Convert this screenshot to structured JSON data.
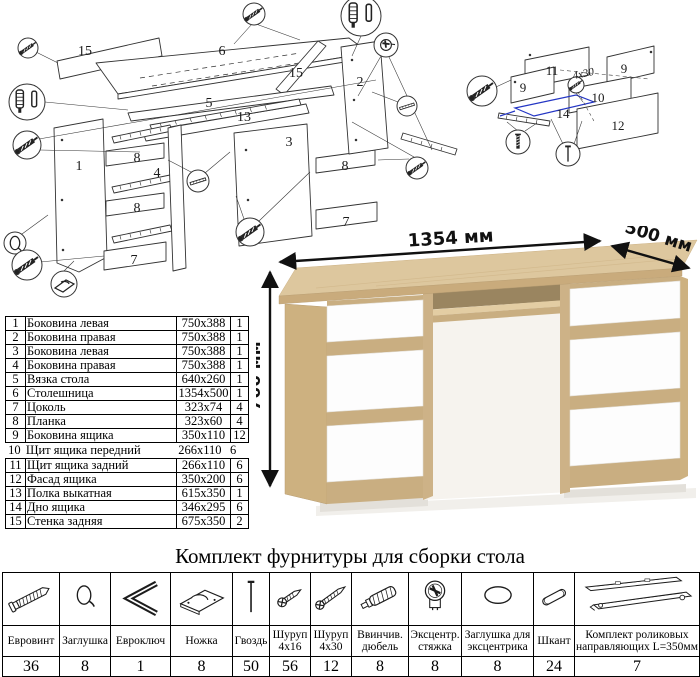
{
  "sheet": {
    "bg": "#ffffff"
  },
  "desk": {
    "dim_width": "1354 мм",
    "dim_depth": "500 мм",
    "dim_height": "766 мм",
    "colors": {
      "oak": "#ddc79e",
      "oak_mid": "#c9ae81",
      "oak_dark": "#9a8560",
      "drawer_white": "#fdfdfd"
    }
  },
  "exploded_main": {
    "labels": [
      "15",
      "6",
      "15",
      "5",
      "2",
      "13",
      "3",
      "8",
      "7",
      "1",
      "8",
      "4",
      "8",
      "7"
    ]
  },
  "exploded_drawer": {
    "labels": [
      "11",
      "9",
      "9",
      "10",
      "14",
      "12"
    ],
    "screw_note": "4x30",
    "accent": "#2436c4"
  },
  "parts_table": {
    "rows": [
      {
        "num": "1",
        "name": "Боковина левая",
        "size": "750x388",
        "qty": "1"
      },
      {
        "num": "2",
        "name": "Боковина правая",
        "size": "750x388",
        "qty": "1"
      },
      {
        "num": "3",
        "name": "Боковина левая",
        "size": "750x388",
        "qty": "1"
      },
      {
        "num": "4",
        "name": "Боковина правая",
        "size": "750x388",
        "qty": "1"
      },
      {
        "num": "5",
        "name": "Вязка стола",
        "size": "640x260",
        "qty": "1"
      },
      {
        "num": "6",
        "name": "Столешница",
        "size": "1354x500",
        "qty": "1"
      },
      {
        "num": "7",
        "name": "Цоколь",
        "size": "323x74",
        "qty": "4"
      },
      {
        "num": "8",
        "name": "Планка",
        "size": "323x60",
        "qty": "4"
      },
      {
        "num": "9",
        "name": "Боковина ящика",
        "size": "350x110",
        "qty": "12"
      },
      {
        "num": "10",
        "name": "Щит ящика передний",
        "size": "266x110",
        "qty": "6"
      },
      {
        "num": "11",
        "name": "Щит ящика задний",
        "size": "266x110",
        "qty": "6"
      },
      {
        "num": "12",
        "name": "Фасад ящика",
        "size": "350x200",
        "qty": "6"
      },
      {
        "num": "13",
        "name": "Полка выкатная",
        "size": "615x350",
        "qty": "1"
      },
      {
        "num": "14",
        "name": "Дно ящика",
        "size": "346x295",
        "qty": "6"
      },
      {
        "num": "15",
        "name": "Стенка задняя",
        "size": "675x350",
        "qty": "2"
      }
    ]
  },
  "hardware": {
    "title": "Комплект фурнитуры для сборки стола",
    "items": [
      {
        "label": "Евровинт",
        "qty": "36",
        "icon": "euroscrew-icon"
      },
      {
        "label": "Заглушка",
        "qty": "8",
        "icon": "cap-icon"
      },
      {
        "label": "Евроключ",
        "qty": "1",
        "icon": "hexkey-icon"
      },
      {
        "label": "Ножка",
        "qty": "8",
        "icon": "foot-icon"
      },
      {
        "label": "Гвоздь",
        "qty": "50",
        "icon": "nail-icon"
      },
      {
        "label": "Шуруп 4x16",
        "qty": "56",
        "icon": "screw-4x16-icon"
      },
      {
        "label": "Шуруп 4x30",
        "qty": "12",
        "icon": "screw-4x30-icon"
      },
      {
        "label": "Ввинчив. дюбель",
        "qty": "8",
        "icon": "screwin-dowel-icon"
      },
      {
        "label": "Эксцентр. стяжка",
        "qty": "8",
        "icon": "cam-lock-icon"
      },
      {
        "label": "Заглушка для эксцентрика",
        "qty": "8",
        "icon": "cam-cap-icon"
      },
      {
        "label": "Шкант",
        "qty": "24",
        "icon": "dowel-icon"
      },
      {
        "label": "Комплект роликовых направляющих L=350мм",
        "qty": "7",
        "icon": "drawer-slides-icon"
      }
    ]
  }
}
